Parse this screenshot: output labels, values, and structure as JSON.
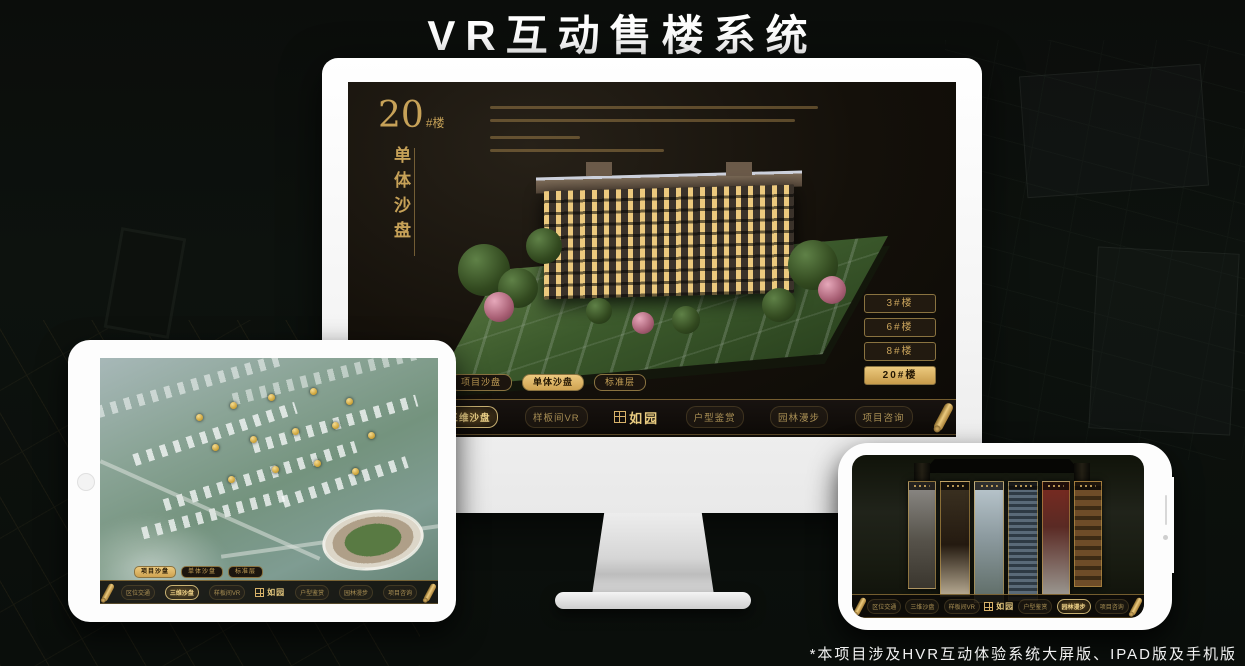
{
  "page": {
    "title": "VR互动售楼系统",
    "footnote": "*本项目涉及HVR互动体验系统大屏版、IPAD版及手机版"
  },
  "colors": {
    "gold": "#c7a258",
    "gold_bright": "#ecca7e",
    "gold_button_text": "#241703",
    "screen_bg": "#14100a",
    "title_text": "#ffffff"
  },
  "icons": {
    "nav_end": "gold-scroll-icon",
    "logo_seal": "seal-square-icon",
    "home": "tablet-home-button",
    "camera": "phone-camera-dot",
    "speaker": "phone-speaker-slit"
  },
  "monitor": {
    "heading": {
      "number": "20",
      "unit": "#楼",
      "vertical_title": "单体沙盘"
    },
    "floor_buttons": [
      {
        "label": "3#楼",
        "active": false
      },
      {
        "label": "6#楼",
        "active": false
      },
      {
        "label": "8#楼",
        "active": false
      },
      {
        "label": "20#楼",
        "active": true
      }
    ],
    "tabs": [
      {
        "label": "项目沙盘",
        "active": false
      },
      {
        "label": "单体沙盘",
        "active": true
      },
      {
        "label": "标准层",
        "active": false
      }
    ],
    "nav": {
      "left_items": [
        {
          "label": "区位交通",
          "active": false
        },
        {
          "label": "三维沙盘",
          "active": true
        },
        {
          "label": "样板间VR",
          "active": false
        }
      ],
      "logo": "如园",
      "right_items": [
        {
          "label": "户型鉴赏",
          "active": false
        },
        {
          "label": "园林漫步",
          "active": false
        },
        {
          "label": "项目咨询",
          "active": false
        }
      ]
    }
  },
  "tablet": {
    "tabs": [
      {
        "label": "项目沙盘",
        "active": true
      },
      {
        "label": "单体沙盘",
        "active": false
      },
      {
        "label": "标准层",
        "active": false
      }
    ],
    "nav": {
      "left_items": [
        {
          "label": "区位交通",
          "active": false
        },
        {
          "label": "三维沙盘",
          "active": true
        },
        {
          "label": "样板间VR",
          "active": false
        }
      ],
      "logo": "如园",
      "right_items": [
        {
          "label": "户型鉴赏",
          "active": false
        },
        {
          "label": "园林漫步",
          "active": false
        },
        {
          "label": "项目咨询",
          "active": false
        }
      ]
    }
  },
  "phone": {
    "nav": {
      "left_items": [
        {
          "label": "区位交通",
          "active": false
        },
        {
          "label": "三维沙盘",
          "active": false
        },
        {
          "label": "样板间VR",
          "active": false
        }
      ],
      "logo": "如园",
      "right_items": [
        {
          "label": "户型鉴赏",
          "active": false
        },
        {
          "label": "园林漫步",
          "active": true
        },
        {
          "label": "项目咨询",
          "active": false
        }
      ]
    }
  }
}
